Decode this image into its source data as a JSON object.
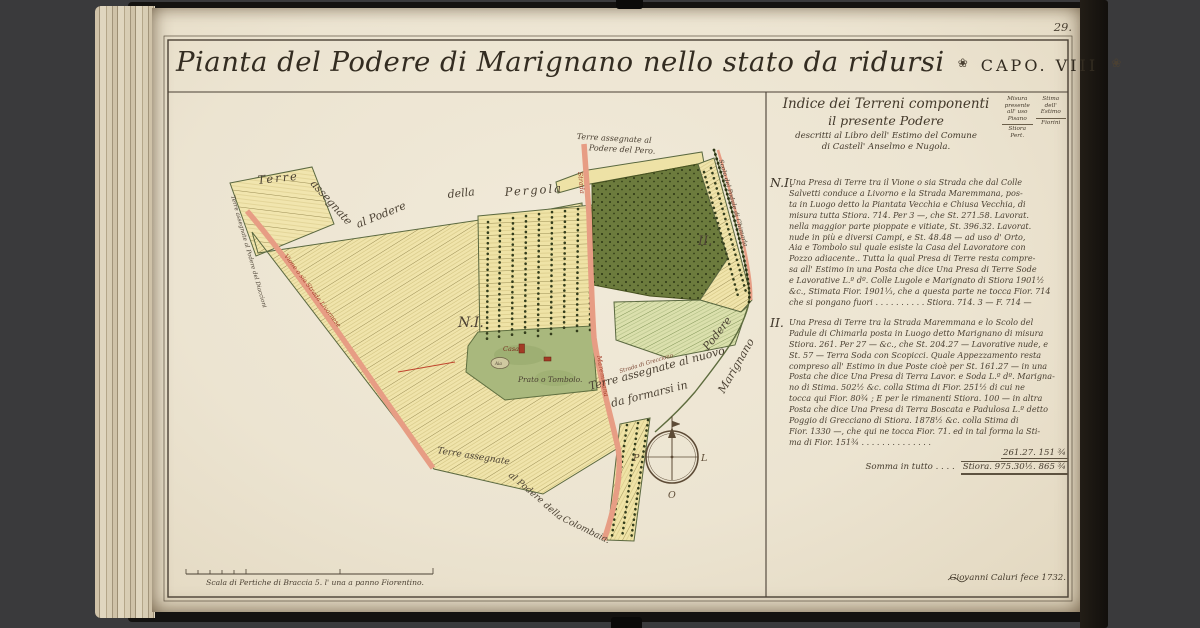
{
  "book": {
    "page_number": "29."
  },
  "title": {
    "text": "Pianta del Podere di Marignano nello stato da ridursi",
    "ornament": "❀",
    "chapter": "CAPO. VIII",
    "ornament2": "❀"
  },
  "index": {
    "heading": [
      "Indice dei Terreni componenti",
      "il presente Podere",
      "descritti al Libro dell' Estimo del Comune",
      "di Castell' Anselmo e Nugola."
    ],
    "measure_col": {
      "lines": [
        "Misura",
        "presente",
        "all' uso",
        "Pisano"
      ],
      "unit": "Stiora Pert."
    },
    "estimate_col": {
      "lines": [
        "Stima",
        "dell'",
        "Estimo"
      ],
      "unit": "Fiorini"
    },
    "items": [
      {
        "label": "N.I.",
        "lines": [
          "Una Presa di Terre tra il Vione o sia Strada che dal Colle",
          "Salvetti conduce a Livorno e la Strada Maremmana, pos-",
          "ta in Luogo detto la Piantata Vecchia e Chiusa Vecchia, di",
          "misura tutta Stiora. 714. Per 3 —, che St. 271.58. Lavorat.",
          "nella maggior parte pioppate e vitiate, St. 396.32. Lavorat.",
          "nude in più e diversi Campi, e St. 48.48 — ad uso d' Orto,",
          "Aia e Tombolo sul quale esiste la Casa del Lavoratore con",
          "Pozzo adiacente.. Tutta la qual Presa di Terre resta compre-",
          "sa all' Estimo in una Posta che dice Una Presa di Terre Sode",
          "e Lavorative L.º dº. Colle Lugole e Marignato di Stiora 1901½",
          "&c., Stimata Fior. 1901⅓, che a questa parte ne tocca Fior. 714",
          "che si pongano fuori . . . . . . . . . .   Stiora. 714. 3 — F. 714 —"
        ]
      },
      {
        "label": "II.",
        "lines": [
          "Una Presa di Terre tra la Strada Maremmana e lo Scolo del",
          "Padule di Chimarla posta in Luogo detto Marignano di misura",
          "Stiora. 261. Per 27 — &c., che St. 204.27 — Lavorative nude, e",
          "St. 57 — Terra Soda con Scopicci.  Quale Appezzamento resta",
          "compreso all' Estimo in due Poste cioè per St. 161.27 — in una",
          "Posta che dice Una Presa di Terra Lavor. e Soda L.º dº. Marigna-",
          "no di Stima. 502½ &c. colla Stima di Fior. 251½ di cui ne",
          "tocca qui Fior. 80¾ ;  E per le rimanenti Stiora. 100 — in altra",
          "Posta che dice Una Presa di Terra Boscata e Padulosa L.º detto",
          "Poggio di Grecciano di Stiora. 1878½ &c. colla Stima di",
          "Fior. 1330 —, che qui ne tocca Fior. 71. ed in tal forma la Sti-",
          "ma di Fior. 151¾ . . . . . . . . . . . . . ."
        ]
      }
    ],
    "item2_figures": "261.27.  151 ¾",
    "total_label": "Somma in tutto . . . .",
    "total_value": "Stiora. 975.30½.  865 ¾"
  },
  "map": {
    "labels": {
      "pergola": [
        "Terre",
        "assegnate",
        "al Podere",
        "della",
        "Pergola"
      ],
      "pero": [
        "Terre assegnate al",
        "Podere del Pero."
      ],
      "diaccioni": "Terre assegnate al Podere del Diaccioni",
      "nuovo": [
        "Terre assegnate al nuovo",
        "Podere",
        "da formarsi in",
        "Marignano"
      ],
      "colombaia": [
        "Terre assegnate",
        "al Podere",
        "della",
        "Colombaia."
      ],
      "parcel1": "N.I.",
      "parcel2": "II.",
      "casa": "Casa",
      "aia": "Aia",
      "prato": "Prato o Tombolo.",
      "strada": "Strada",
      "maremmana": "Maremmana",
      "vione": "Vione o sia Strada Livornese",
      "scolo": "Scolo del Padule di Chimarla",
      "grecciano": "Strada di Grecciano"
    },
    "compass": {
      "west": "P",
      "east": "L",
      "south": "O"
    },
    "colors": {
      "road": "#e79d84",
      "woods": "#6c7b3d",
      "meadow": "#a9b87d",
      "parcel": "#f0e4ab",
      "ink": "#4b4133",
      "red_label": "#a13a27"
    }
  },
  "footer": {
    "scale_caption": "Scala di Pertiche di Braccia 5. l' una a panno Fiorentino.",
    "signature": "Giovanni Caluri fece 1732."
  }
}
